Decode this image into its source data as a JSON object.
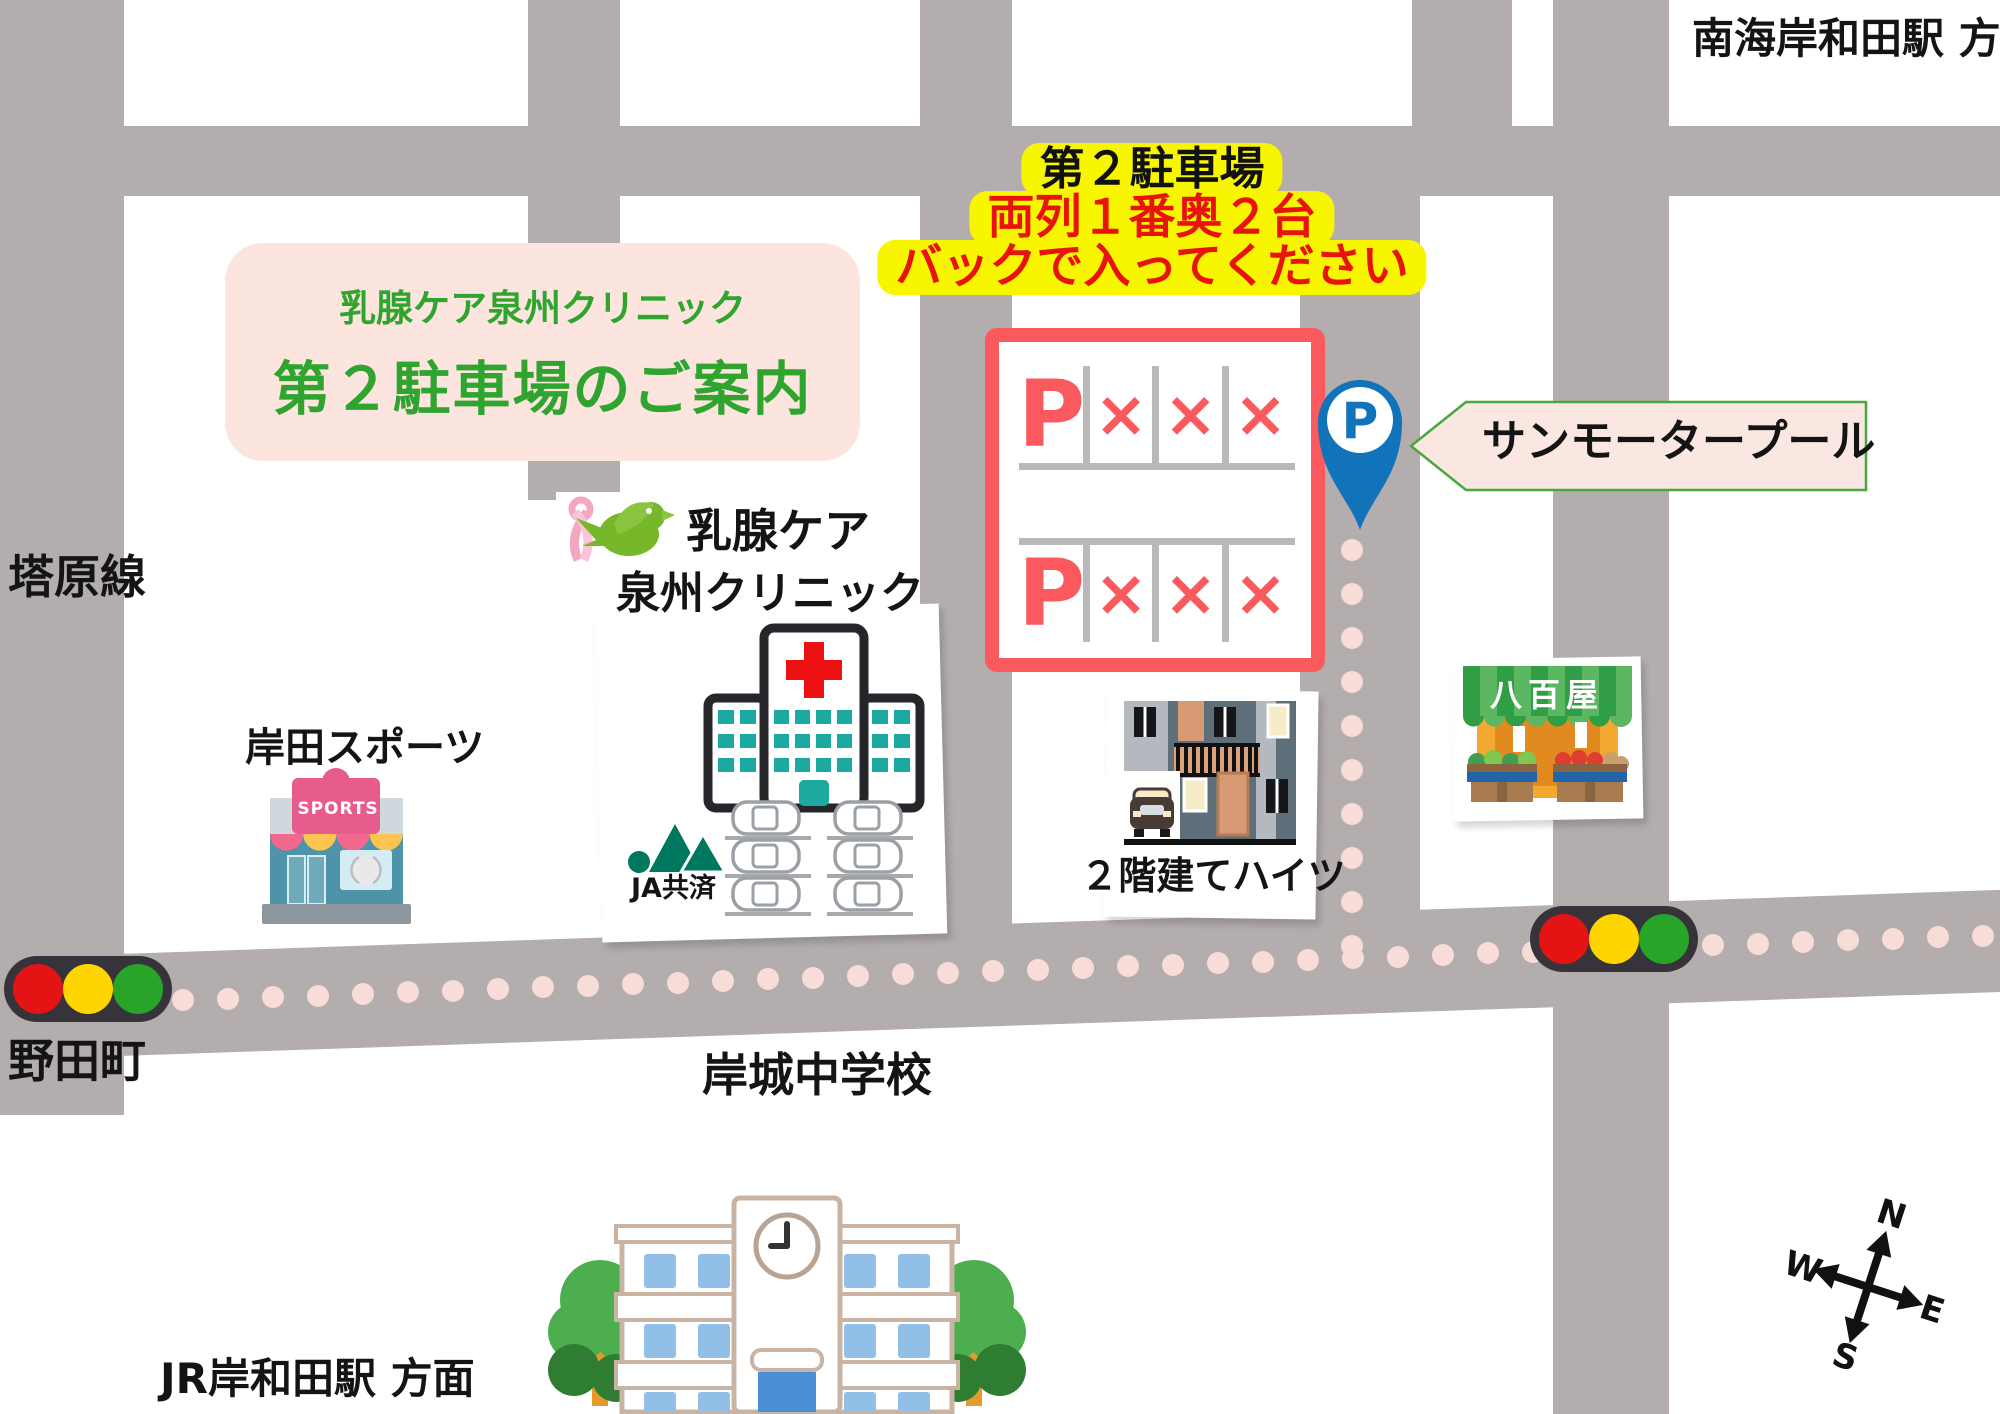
{
  "colors": {
    "road_gray": "#b3adad",
    "route_dot_pink": "#f8dcd8",
    "warning_bg_yellow": "#f7f500",
    "warning_text_red": "#e8140c",
    "guide_green": "#2fa42f",
    "guide_bg_pink": "#fce5de",
    "parking_red": "#fa5a5e",
    "pin_blue": "#1173b9",
    "signal_red": "#e51414",
    "signal_yellow": "#ffd500",
    "signal_green": "#28a428"
  },
  "header": {
    "nankai_direction": "南海岸和田駅 方面",
    "jr_direction": "JR岸和田駅 方面"
  },
  "title_box": {
    "line1": "乳腺ケア泉州クリニック",
    "line2": "第２駐車場のご案内"
  },
  "warning_box": {
    "line1": "第２駐車場",
    "line2": "両列１番奥２台",
    "line3": "バックで入ってください"
  },
  "parking_lot": {
    "rows": [
      [
        "P",
        "×",
        "×",
        "×"
      ],
      [
        "P",
        "×",
        "×",
        "×"
      ]
    ],
    "pin_letter": "P",
    "name": "サンモータープール"
  },
  "clinic": {
    "name_line1": "乳腺ケア",
    "name_line2": "泉州クリニック",
    "ja_label": "JA共済"
  },
  "places": {
    "tonohara_line": "塔原線",
    "noda_cho": "野田町",
    "sports_shop": "岸田スポーツ",
    "sports_sign": "SPORTS",
    "heights": "２階建てハイツ",
    "vegetable_shop": "八百屋",
    "school": "岸城中学校"
  },
  "compass": {
    "n": "N",
    "e": "E",
    "s": "S",
    "w": "W"
  }
}
